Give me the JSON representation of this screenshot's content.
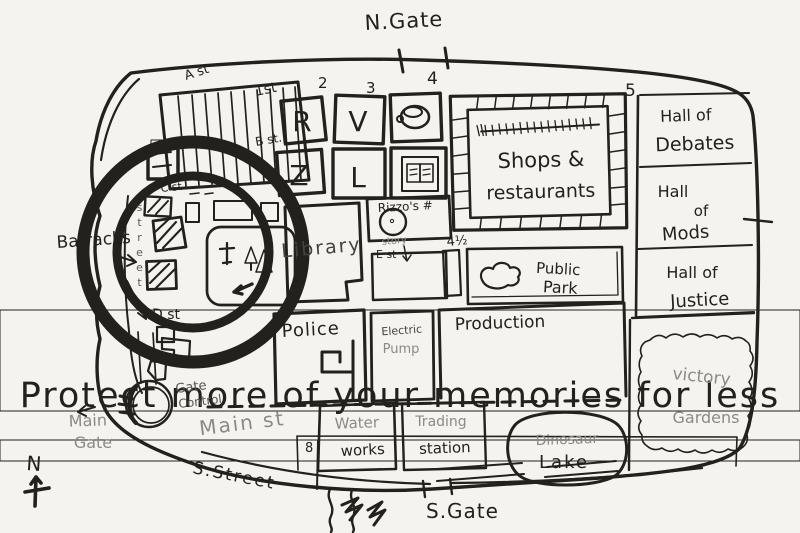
{
  "watermark": {
    "text": "Protect more of your memories for less"
  },
  "compass": {
    "direction": "N"
  },
  "gates": {
    "north": "N.Gate",
    "south": "S.Gate",
    "main": [
      "Main",
      "Gate"
    ],
    "control": [
      "Gate",
      "Control"
    ]
  },
  "streets": {
    "a": "A st",
    "b": "B st.",
    "c": "C st",
    "d": "D st",
    "e": "E st",
    "left_vertical": "street",
    "n1": "1st",
    "n2": "2",
    "n3": "3",
    "n4": "4",
    "n4half": "4½",
    "n5": "5",
    "n8": "8",
    "main": "Main st",
    "south": "S.Street"
  },
  "places": {
    "barracks": "Barracks",
    "box_r": "R",
    "box_v": "V",
    "box_z": "Z",
    "box_l": "L",
    "shops": [
      "Shops &",
      "restaurants"
    ],
    "hall_of_debates": [
      "Hall of",
      "Debates"
    ],
    "hall_of_mods": [
      "Hall",
      "of",
      "Mods"
    ],
    "hall_of_justice": [
      "Hall of",
      "Justice"
    ],
    "library": "Library",
    "rizzos": "Rizzo's #",
    "rizzos_note": "story",
    "public_park": [
      "Public",
      "Park"
    ],
    "police": "Police",
    "electric_pump": [
      "Electric",
      "Pump"
    ],
    "production": "Production",
    "water_works": [
      "Water",
      "works"
    ],
    "trading_station": [
      "Trading",
      "station"
    ],
    "dinosaur_lake": [
      "Dinosaur",
      "Lake"
    ],
    "victory_gardens": [
      "victory",
      "Gardens"
    ]
  },
  "colors": {
    "ink": "#23211d",
    "pencil": "#8d8a85",
    "paper": "#f5f3ef",
    "watermark": "#e9e6e0"
  }
}
